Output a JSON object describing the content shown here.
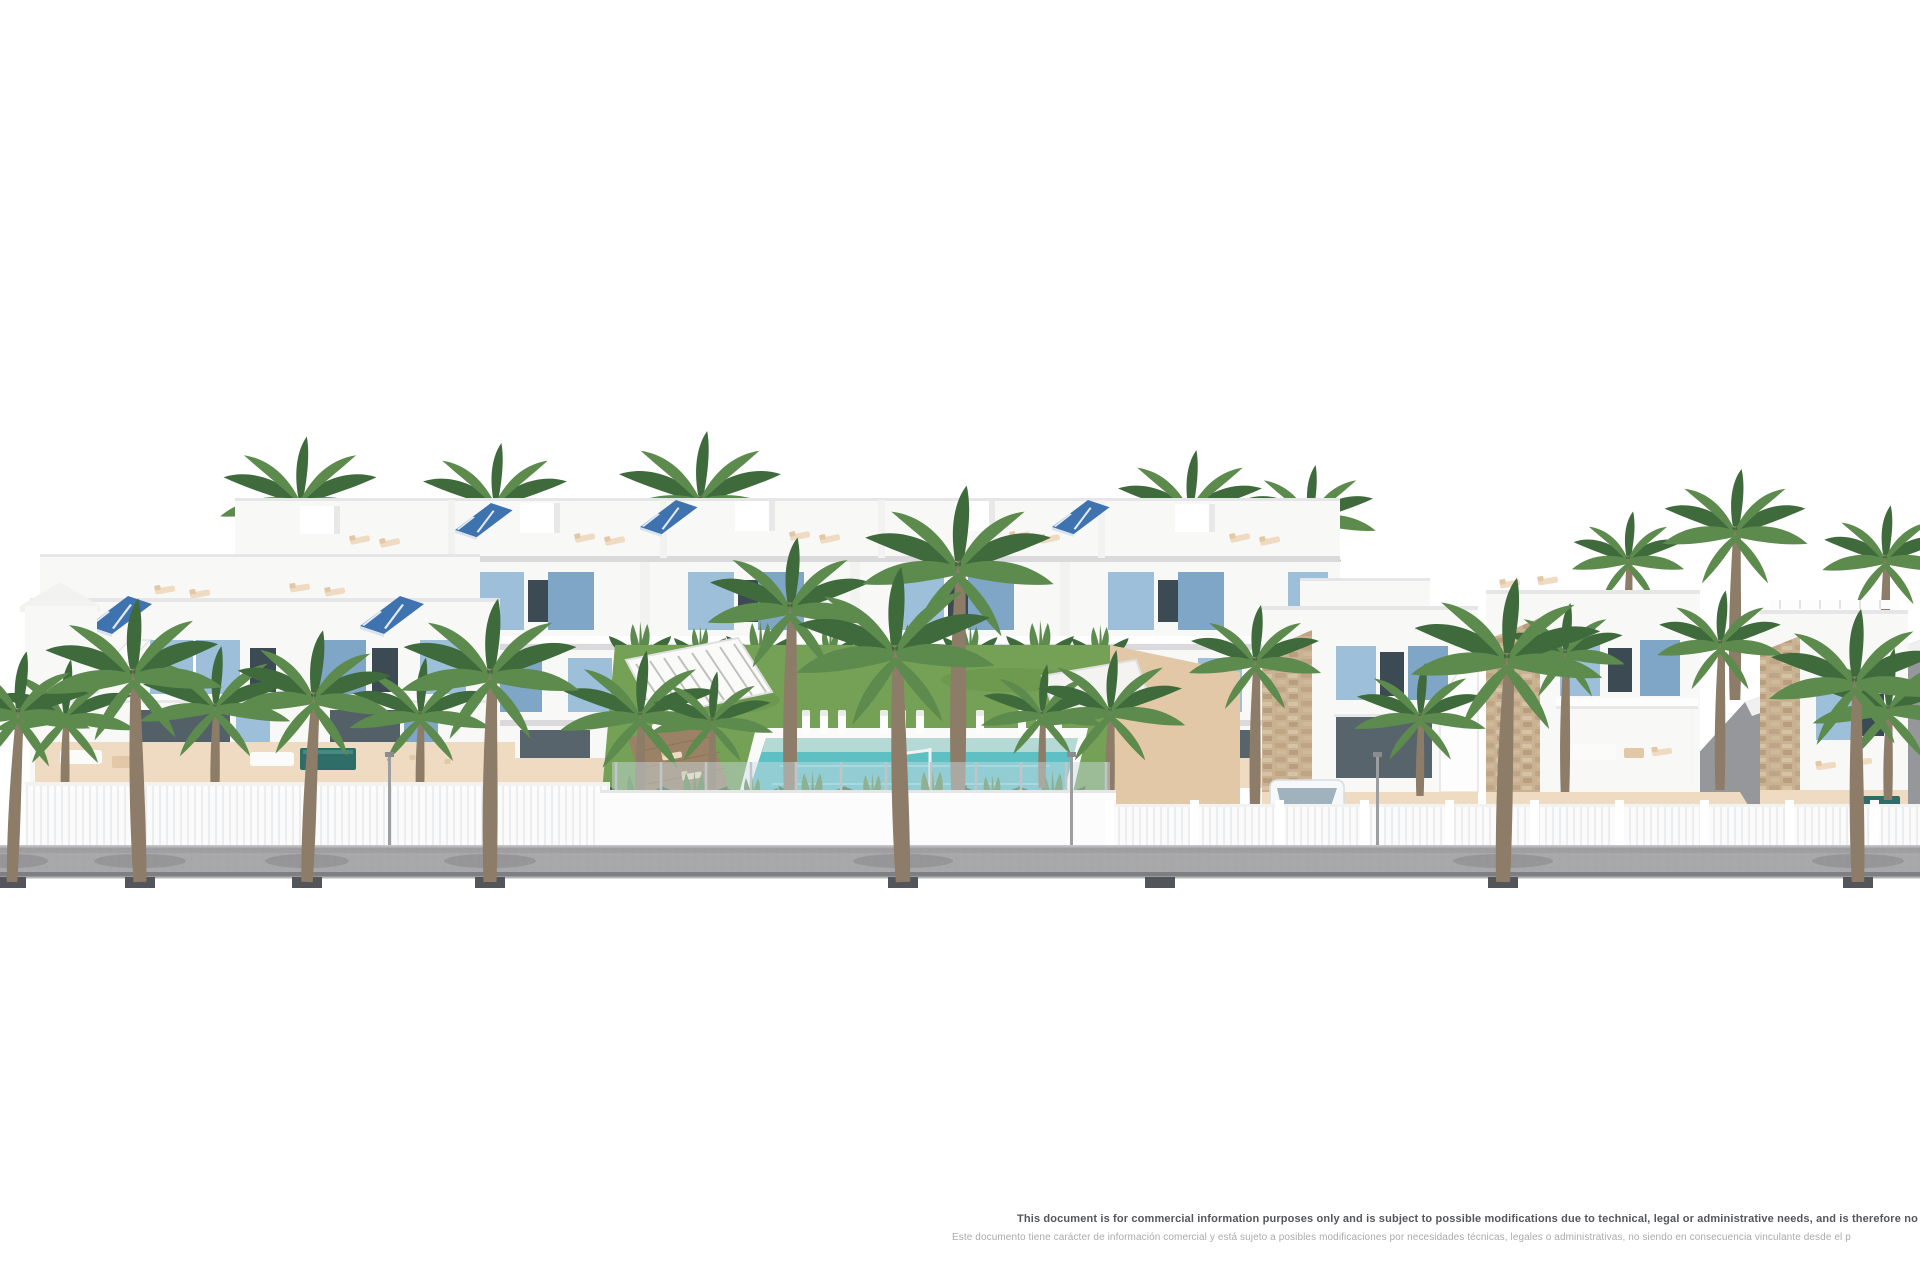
{
  "canvas": {
    "width": 1920,
    "height": 1280,
    "background": "#ffffff"
  },
  "image": {
    "type": "architectural-render",
    "subject": "New-build Mediterranean residential development: white terraced apartments and villas with light-blue shutters, rooftop solar panels and roof terraces, communal lawn garden with rectangular pool and sun loungers, palm trees along a grey sidewalk"
  },
  "disclaimer": {
    "en": "This document is for commercial information purposes only and is subject to possible modifications due to technical, legal or administrative needs, and is therefore no",
    "es": "Este documento tiene carácter de información comercial y está sujeto a posibles modificaciones por necesidades técnicas, legales o administrativas, no siendo en consecuencia vinculante desde el p"
  },
  "colors": {
    "background": "#ffffff",
    "wall_white": "#f8f8f7",
    "wall_shade": "#e8e8e9",
    "wall_shadow": "#dadadc",
    "shutter_blue": "#9dbfda",
    "shutter_dark": "#7fa6c6",
    "solar_blue": "#3f73b0",
    "window_dark": "#3c4a54",
    "glass_light": "#cfdde6",
    "terrace_sand": "#eedbc2",
    "terrace_sand_dark": "#e2c8a6",
    "wood_brown": "#9b8266",
    "stone_tan": "#c9b292",
    "lawn_green": "#74a156",
    "lawn_dark": "#5f8a43",
    "palm_green": "#5d8a4d",
    "palm_dark": "#3f6b3c",
    "trunk_brown": "#8d7c67",
    "pool_teal": "#5fc0c3",
    "pool_light": "#bfdcd6",
    "plunge_teal": "#2f6e68",
    "road_gray": "#a8a8aa",
    "curb_gray": "#7e7f82",
    "planter_gray": "#53555a",
    "flower_red": "#b5372c",
    "text_en": "#55565a",
    "text_es": "#ababad"
  },
  "scene": {
    "elements": [
      "rear-apartment-row",
      "left-apartment-block",
      "communal-garden",
      "swimming-pool",
      "pergola",
      "right-villas",
      "access-ramp",
      "parked-van",
      "parked-car",
      "perimeter-fence",
      "sidewalk",
      "palm-trees"
    ]
  }
}
